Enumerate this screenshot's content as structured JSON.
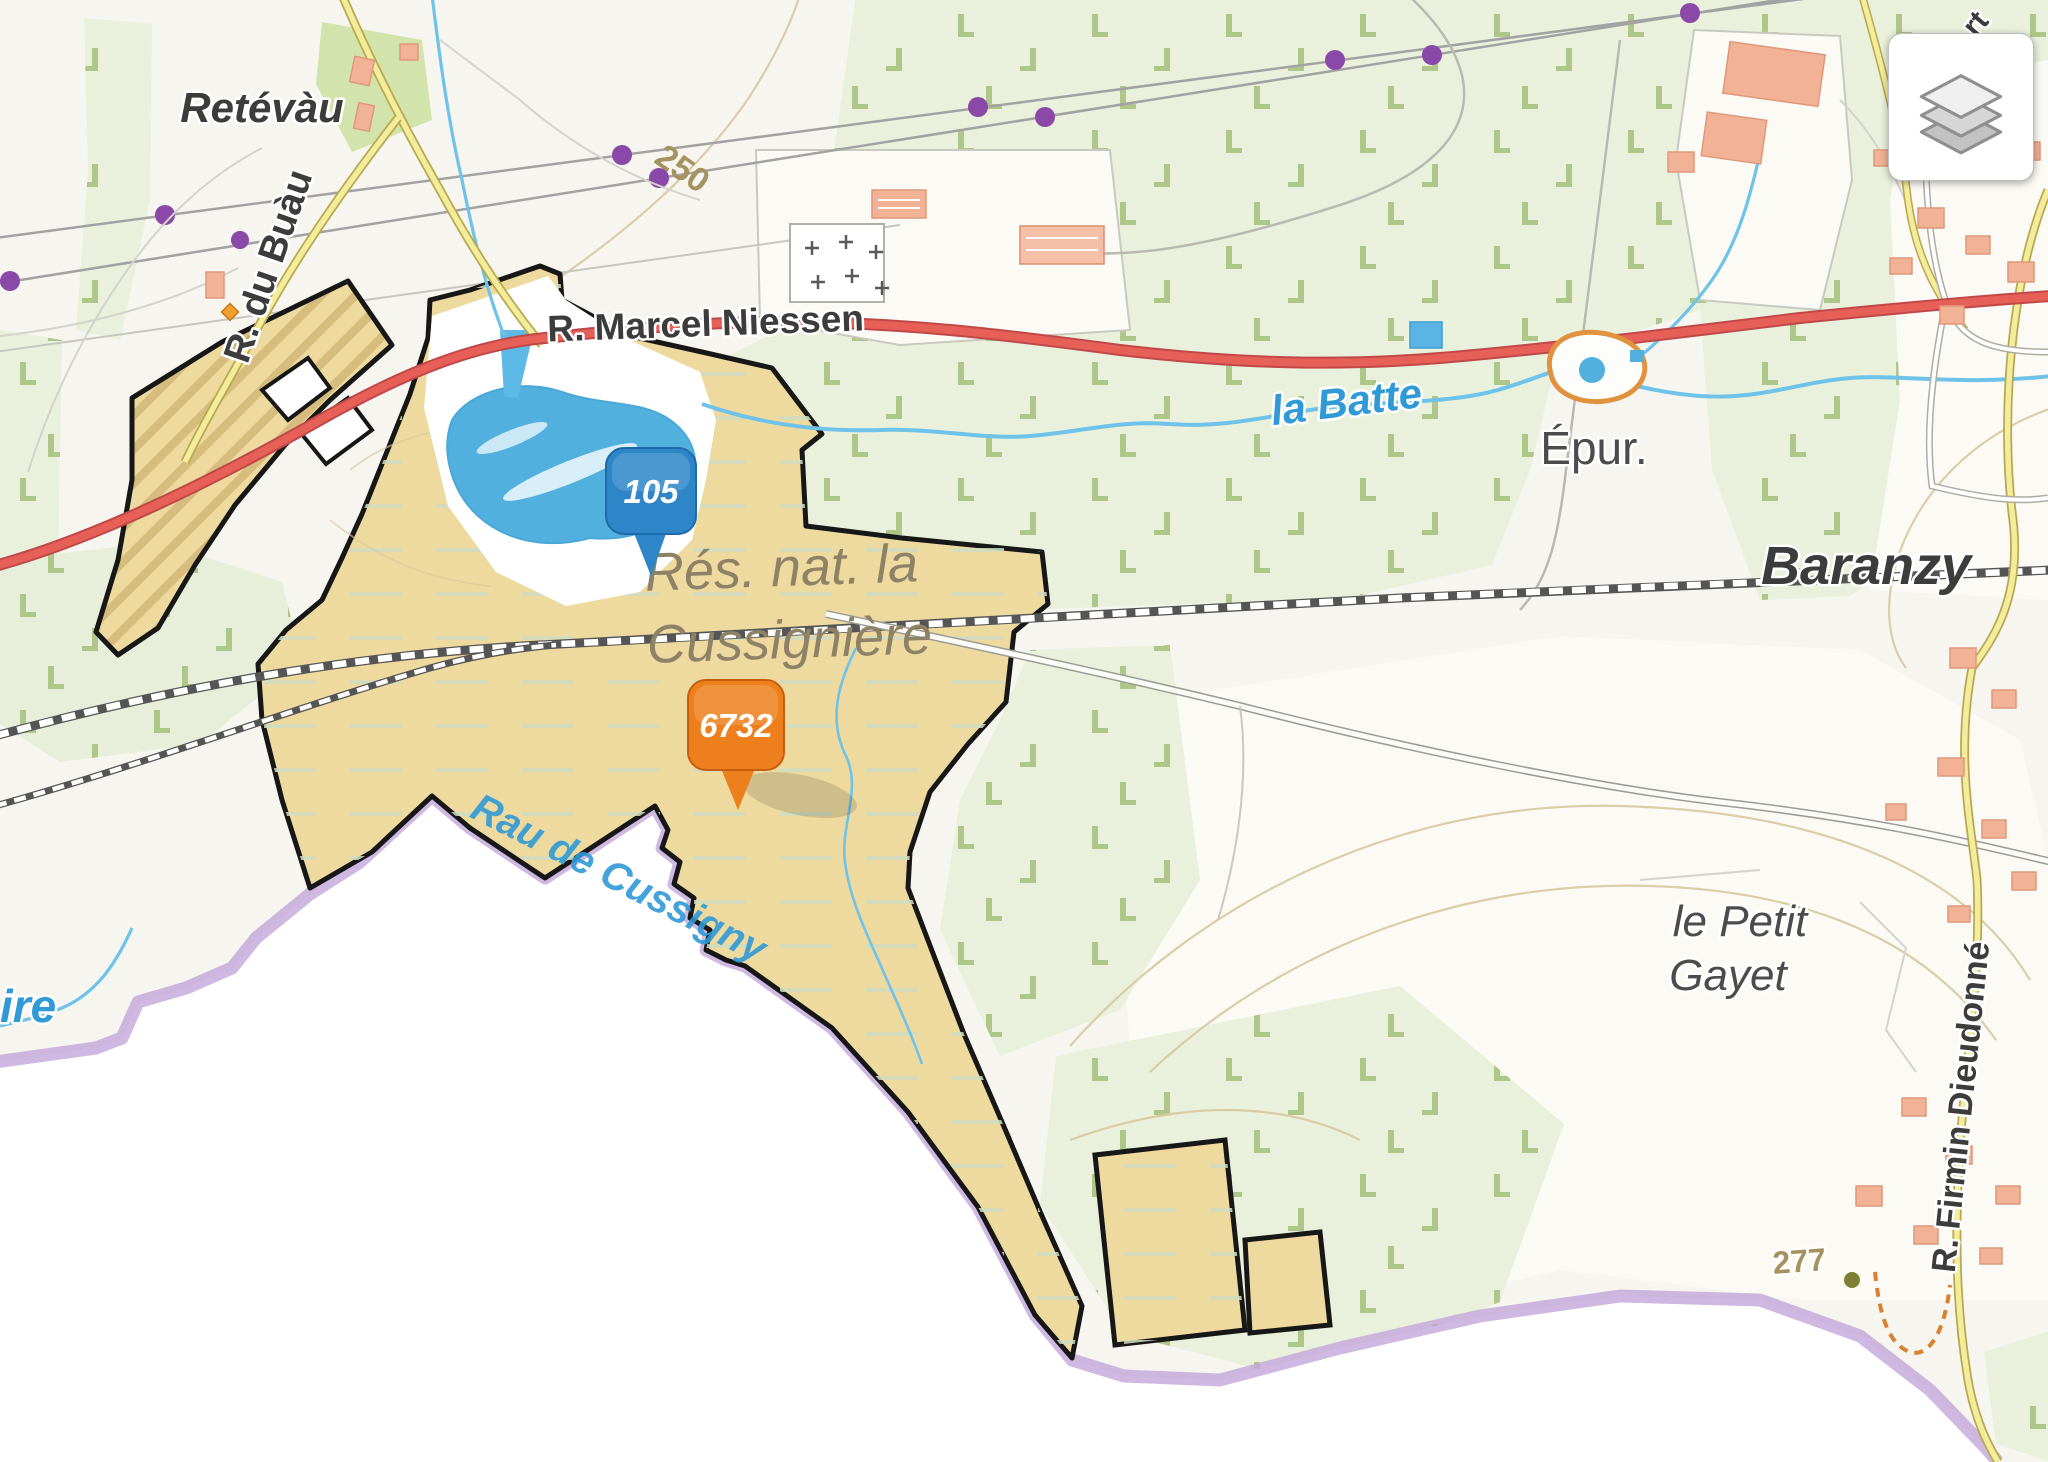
{
  "map": {
    "place_labels": {
      "retevau": "Retévàu",
      "baranzy": "Baranzy",
      "epur": "Épur.",
      "petit_gayet_1": "le Petit",
      "petit_gayet_2": "Gayet",
      "reserve_1": "Rés. nat. la",
      "reserve_2": "Cussignière"
    },
    "road_labels": {
      "marcel_niessen": "R. Marcel Niessen",
      "du_buau": "R. du Buàu",
      "firmin": "R. Firmin Dieudonné",
      "partial_top_right": "rt"
    },
    "water_labels": {
      "la_batte": "la Batte",
      "rau_de_cussigny": "Rau de Cussigny",
      "partial_left": "ire"
    },
    "elevation": {
      "contour_250": "250",
      "spot_277": "277"
    },
    "markers": {
      "blue": {
        "value": "105",
        "color": "#2e86c8"
      },
      "orange": {
        "value": "6732",
        "color": "#ee7f1d"
      }
    },
    "icons": {
      "layers": "layers-icon"
    },
    "colors": {
      "reserve_fill": "#eeda9f",
      "forest_fill": "#e9f1dc",
      "water": "#5db9e6",
      "main_road": "#e2635c",
      "country_border": "#c3a6da",
      "marker_blue": "#2e86c8",
      "marker_orange": "#ee7f1d"
    }
  }
}
